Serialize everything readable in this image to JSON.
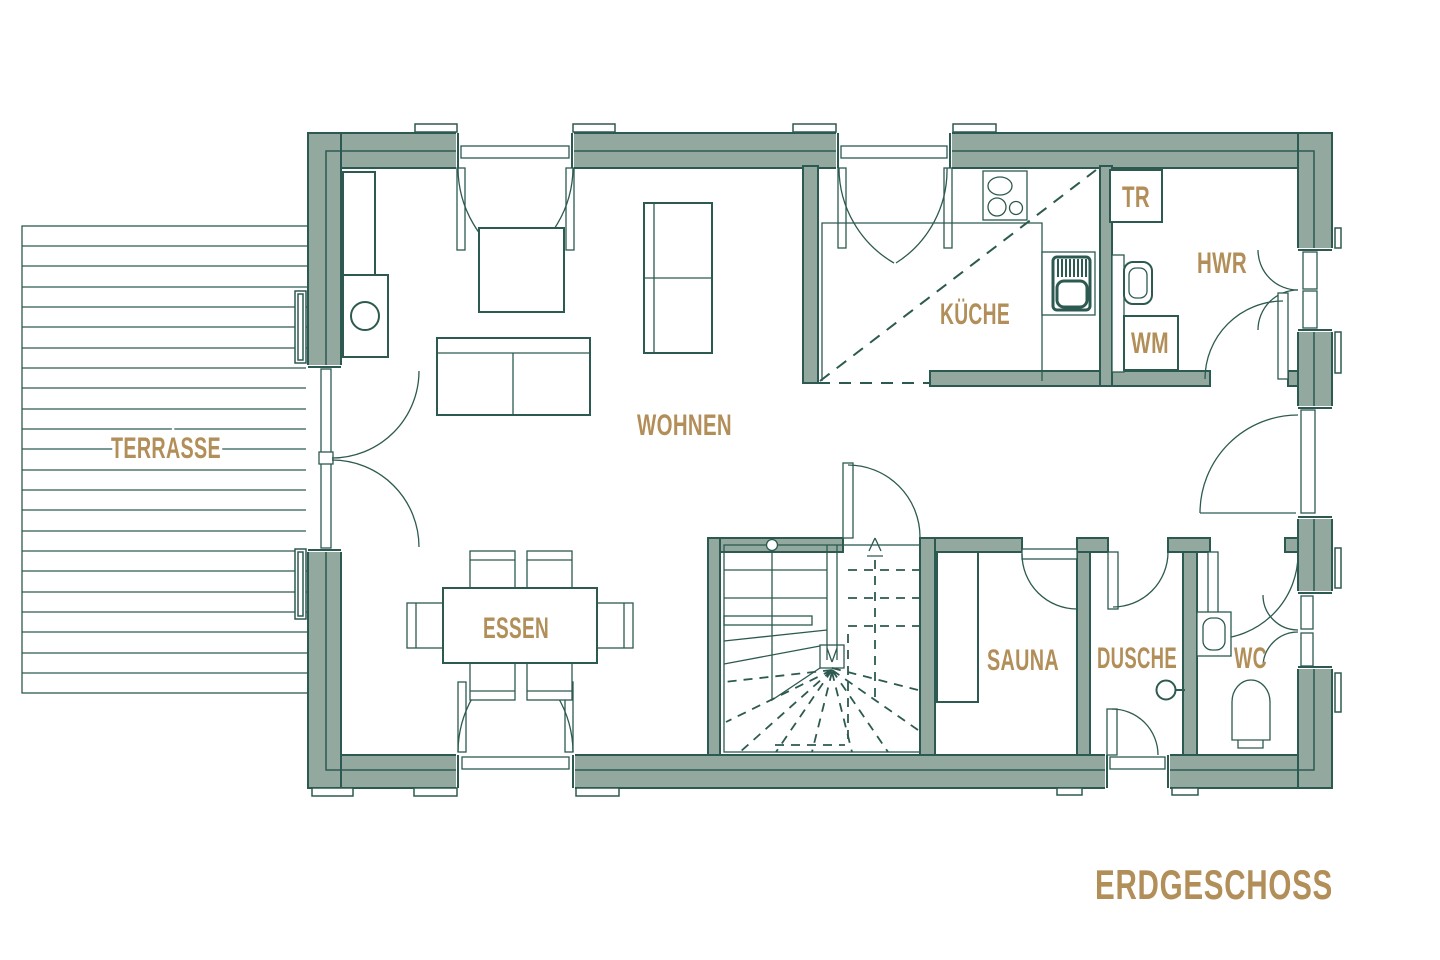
{
  "plan": {
    "title": "ERDGESCHOSS",
    "colors": {
      "wall_fill": "#93a9a0",
      "line": "#2d5a50",
      "label": "#b28e58",
      "background": "#ffffff"
    },
    "rooms": [
      {
        "id": "terrasse",
        "label": "TERRASSE"
      },
      {
        "id": "wohnen",
        "label": "WOHNEN"
      },
      {
        "id": "essen",
        "label": "ESSEN"
      },
      {
        "id": "kueche",
        "label": "KÜCHE"
      },
      {
        "id": "tr",
        "label": "TR"
      },
      {
        "id": "hwr",
        "label": "HWR"
      },
      {
        "id": "wm",
        "label": "WM"
      },
      {
        "id": "sauna",
        "label": "SAUNA"
      },
      {
        "id": "dusche",
        "label": "DUSCHE"
      },
      {
        "id": "wc",
        "label": "WC"
      }
    ],
    "symbols": [
      "terrace-decking",
      "fireplace-icon",
      "sofa-icon",
      "coffee-table-icon",
      "sideboard-icon",
      "dining-table-icon",
      "dining-chair-icon",
      "french-door-icon",
      "stove-icon",
      "kitchen-sink-icon",
      "dryer-box",
      "washing-machine-box",
      "utility-sink-icon",
      "stairs-icon",
      "up-arrow-icon",
      "sauna-bench-icon",
      "shower-head-icon",
      "washbasin-icon",
      "toilet-icon",
      "window-icon",
      "door-swing-icon"
    ]
  }
}
